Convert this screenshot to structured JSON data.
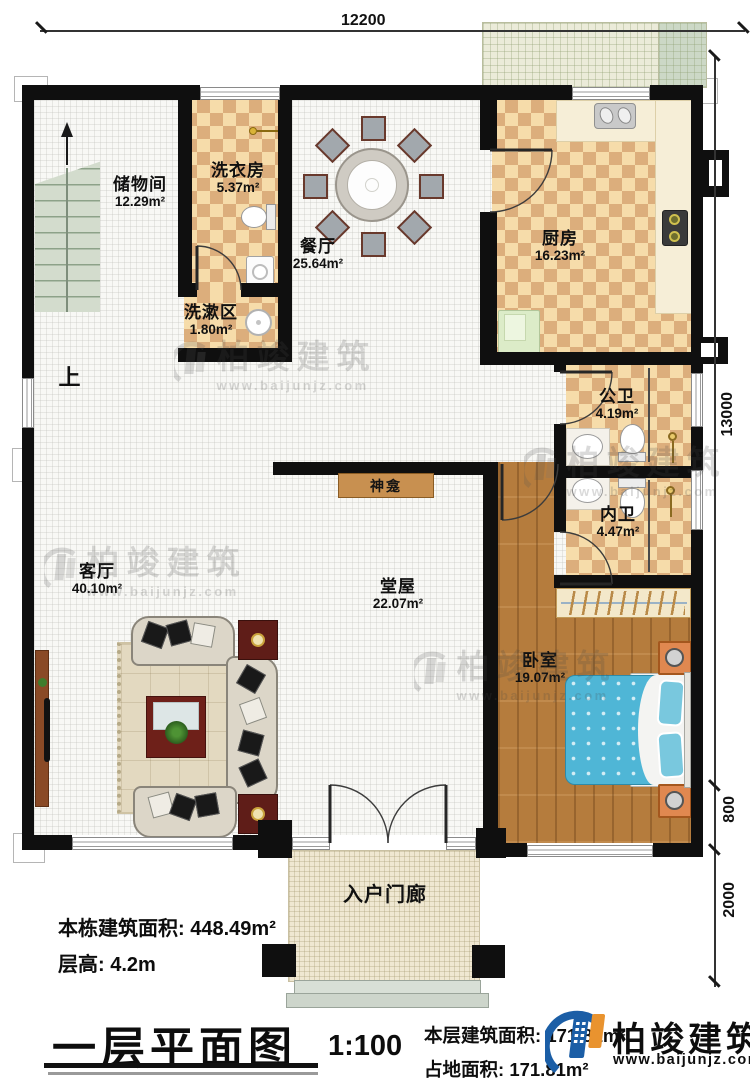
{
  "plan": {
    "dim_top": "12200",
    "dim_right_main": "13000",
    "dim_right_mid": "800",
    "dim_right_low": "2000",
    "stairs_up": "上",
    "rooms": {
      "storage": {
        "name": "储物间",
        "area": "12.29m²"
      },
      "laundry": {
        "name": "洗衣房",
        "area": "5.37m²"
      },
      "dining": {
        "name": "餐厅",
        "area": "25.64m²"
      },
      "kitchen": {
        "name": "厨房",
        "area": "16.23m²"
      },
      "wash": {
        "name": "洗漱区",
        "area": "1.80m²"
      },
      "public_bath": {
        "name": "公卫",
        "area": "4.19m²"
      },
      "inner_bath": {
        "name": "内卫",
        "area": "4.47m²"
      },
      "living": {
        "name": "客厅",
        "area": "40.10m²"
      },
      "hall": {
        "name": "堂屋",
        "area": "22.07m²"
      },
      "bedroom": {
        "name": "卧室",
        "area": "19.07m²"
      },
      "porch": {
        "name": "入户门廊"
      },
      "shrine": {
        "name": "神龛"
      }
    }
  },
  "info": {
    "total_area_label": "本栋建筑面积:",
    "total_area_value": "448.49m²",
    "floor_height_label": "层高:",
    "floor_height_value": "4.2m"
  },
  "footer": {
    "title": "一层平面图",
    "scale": "1:100",
    "floor_area_label": "本层建筑面积:",
    "floor_area_value": "171.81m²",
    "ground_area_label": "占地面积:",
    "ground_area_value": "171.81m²"
  },
  "brand": {
    "name": "柏竣建筑",
    "url": "www.baijunjz.com"
  },
  "watermark": {
    "name": "柏竣建筑",
    "url": "www.baijunjz.com"
  },
  "colors": {
    "wall": "#0f0f0f",
    "checker_light": "#f6dcaa",
    "checker_dark": "#dcae7c",
    "wood": "#b57c3d",
    "bed_blue": "#4fb6d6",
    "nightstand_orange": "#e08850",
    "brand_blue": "#1b5ea6",
    "brand_orange": "#e9932f"
  }
}
